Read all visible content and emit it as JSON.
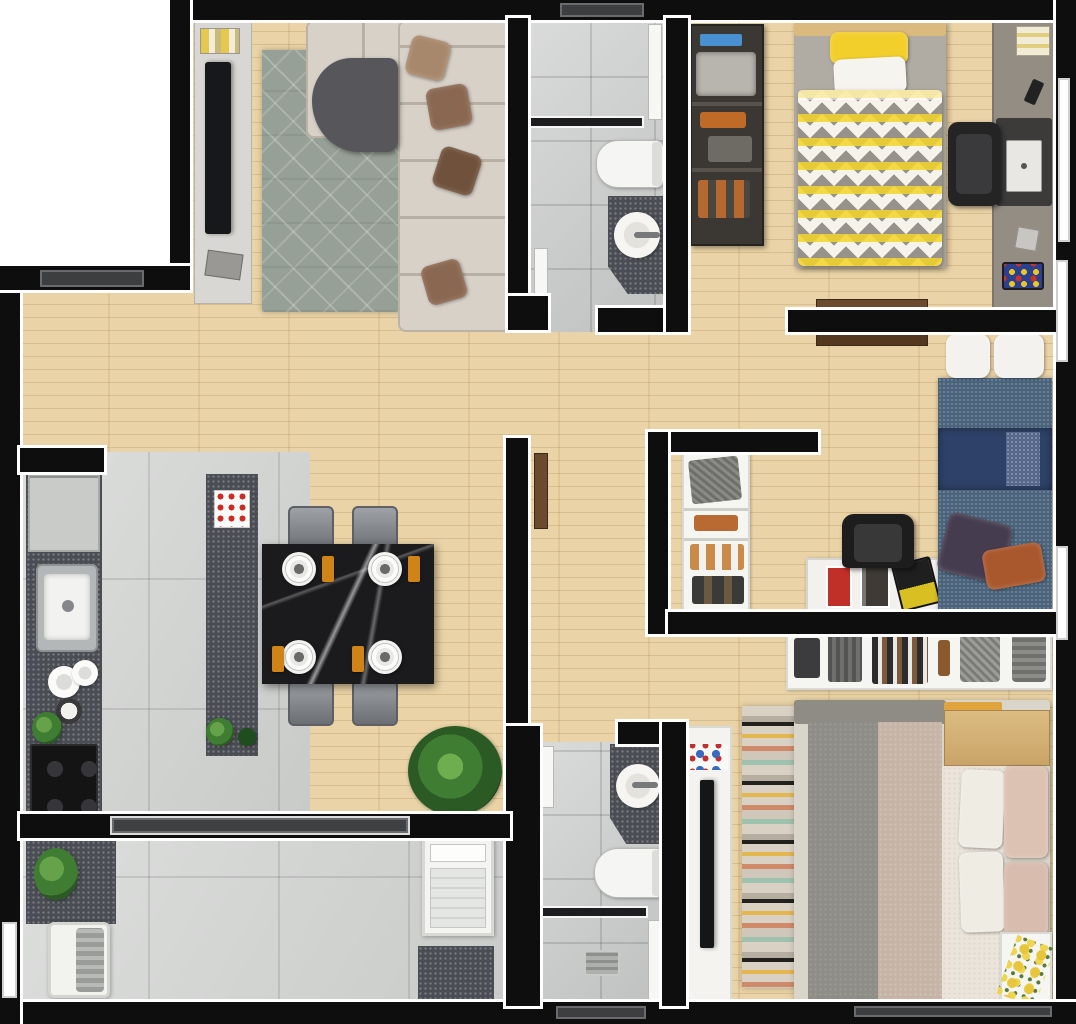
{
  "scene": {
    "kind": "apartment-floor-plan",
    "view": "top-down-3d-render",
    "visible_text": "",
    "units": "2-bedroom-plus-office apartment with living room, kitchen, dining, laundry, two bathrooms"
  },
  "palette": {
    "wall": "#0e0e0f",
    "wood": "#e9d1a2",
    "tile": "#cbcdcc",
    "tileBig": "#d3d5d3",
    "granite": "#4a4d53",
    "rugLiving": "#96a096",
    "cream": "#d8d1c8",
    "brown": "#8a6750",
    "doorBrown": "#6b4a2f",
    "marble": "#1b1b1d",
    "orange": "#d08418",
    "accentYellow": "#f2cf2a",
    "denim": "#4a647c",
    "navy": "#2e4168",
    "rust": "#a9572c",
    "purple": "#463c50",
    "blush": "#dcc2b2",
    "taupe": "#c6b5a7",
    "greenPlant": "#3e7d32"
  },
  "rooms": [
    {
      "id": "living-room",
      "floor": "wood",
      "furniture": [
        "tv-sideboard",
        "wall-tv",
        "media-console",
        "area-rug",
        "l-shaped-sectional-sofa",
        "curved-chaise",
        "throw-pillows"
      ]
    },
    {
      "id": "bathroom-1",
      "floor": "gray-tile",
      "furniture": [
        "shower",
        "glass-partition",
        "shower-screen",
        "toilet",
        "granite-vanity",
        "round-sink"
      ]
    },
    {
      "id": "bedroom-1",
      "floor": "wood",
      "furniture": [
        "open-wardrobe",
        "single-bed-chevron-duvet",
        "yellow-pillow",
        "white-pillow",
        "desk",
        "office-chair",
        "laptop",
        "desk-mat",
        "papers",
        "phone"
      ]
    },
    {
      "id": "bedroom-2",
      "floor": "wood",
      "furniture": [
        "open-shelf-unit",
        "denim-daybed",
        "navy-blanket",
        "purple-pillow",
        "rust-pillow",
        "white-back-cushions",
        "white-desk",
        "office-chair",
        "desk-posters",
        "laptop"
      ]
    },
    {
      "id": "kitchen",
      "floor": "large-tile",
      "furniture": [
        "fridge",
        "granite-counter",
        "stainless-sink",
        "plates",
        "pot",
        "herb-plant",
        "cooktop",
        "granite-island",
        "red-checked-towel",
        "island-plants"
      ]
    },
    {
      "id": "dining-area",
      "floor": "wood",
      "furniture": [
        "black-marble-table",
        "gray-chair-1",
        "gray-chair-2",
        "gray-chair-3",
        "gray-chair-4",
        "place-setting-plates",
        "orange-napkins",
        "potted-plant"
      ]
    },
    {
      "id": "laundry",
      "floor": "large-tile",
      "furniture": [
        "granite-counter",
        "plant",
        "wash-tank-sink",
        "washing-machine",
        "granite-counter-2"
      ]
    },
    {
      "id": "bathroom-2",
      "floor": "gray-tile",
      "furniture": [
        "granite-vanity",
        "round-sink",
        "toilet",
        "glass-partition",
        "shower",
        "shower-screen",
        "floor-drain"
      ]
    },
    {
      "id": "master-bedroom",
      "floor": "wood",
      "furniture": [
        "open-shelf-with-clothes",
        "double-bed",
        "gray-duvet",
        "taupe-duvet",
        "cream-duvet",
        "blush-pillows",
        "wood-headboard-bench",
        "striped-rug",
        "dresser-strip",
        "wall-tv",
        "nightstand",
        "yellow-flowers"
      ]
    },
    {
      "id": "hallway",
      "floor": "wood",
      "furniture": [
        "bedroom1-door-leaf",
        "bedroom2-door-leaf"
      ]
    },
    {
      "id": "corridor",
      "floor": "wood",
      "furniture": [
        "corridor-door-leaf",
        "bathroom2-door-leaf"
      ]
    }
  ],
  "openings": {
    "windows_right_wall": 3,
    "window_step_wall": 1,
    "windows_bottom_wall": 2,
    "glass_door_kitchen_to_laundry": 1
  }
}
